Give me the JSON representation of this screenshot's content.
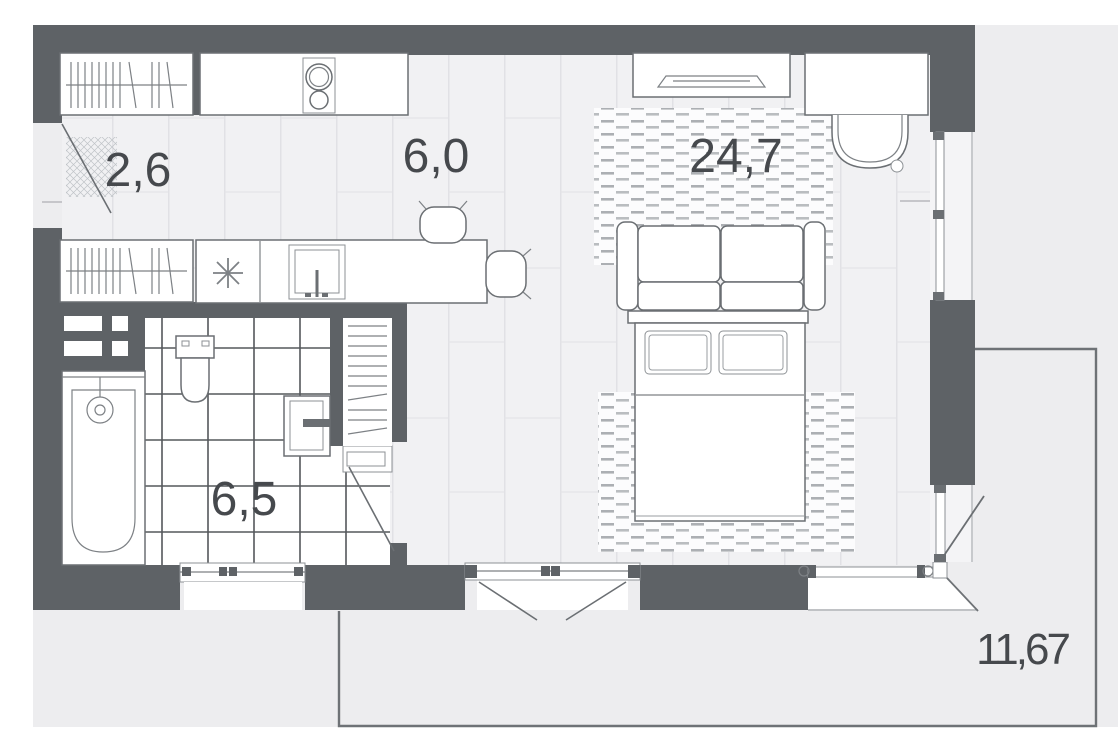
{
  "plan": {
    "type": "studio-apartment-floor-plan",
    "rooms": {
      "hallway": {
        "area": "2,6"
      },
      "kitchen": {
        "area": "6,0"
      },
      "living": {
        "area": "24,7"
      },
      "bathroom": {
        "area": "6,5"
      },
      "terrace": {
        "area": "11,67"
      }
    },
    "furniture_symbols": [
      "wardrobe-icon",
      "entrance-door-icon",
      "doormat-icon",
      "kitchen-counter-icon",
      "cooktop-icon",
      "kitchen-island-icon",
      "sink-icon",
      "asterisk-icon",
      "bar-chair-icon",
      "tv-console-icon",
      "tv-icon",
      "desk-icon",
      "desk-chair-icon",
      "rug-icon",
      "sofa-icon",
      "double-bed-icon",
      "pillow-icon",
      "bathtub-icon",
      "shower-icon",
      "toilet-icon",
      "washbasin-icon",
      "shelf-closet-icon",
      "window-icon",
      "balcony-door-icon",
      "ventilation-shaft-icon"
    ],
    "colors": {
      "wall": "#5e6266",
      "floor": "#f1f1f3",
      "outside": "#ededef",
      "outline": "#6b6f73",
      "label": "#46494d"
    }
  }
}
